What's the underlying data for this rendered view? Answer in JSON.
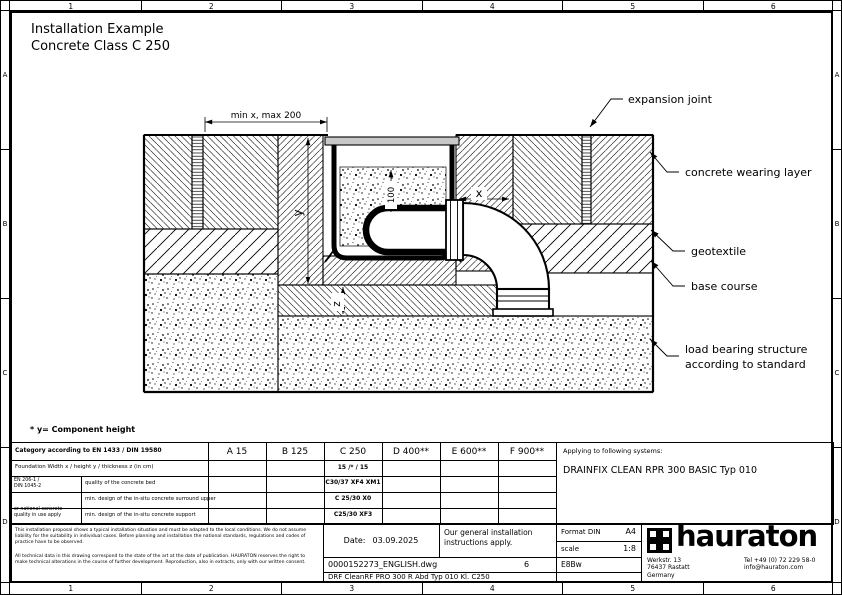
{
  "sheet": {
    "title1": "Installation Example",
    "title2": "Concrete Class C 250",
    "footnote": "* y= Component height"
  },
  "border": {
    "cols": [
      "1",
      "2",
      "3",
      "4",
      "5",
      "6"
    ],
    "rows": [
      "A",
      "B",
      "C",
      "D"
    ]
  },
  "drawing": {
    "dims": {
      "top": "min x, max 200",
      "y": "y",
      "depth": "100",
      "x": "x",
      "z": "z"
    },
    "callouts": {
      "expansion_joint": "expansion joint",
      "wearing_layer": "concrete wearing layer",
      "geotextile": "geotextile",
      "base_course": "base course",
      "load_bearing_1": "load bearing structure",
      "load_bearing_2": "according to standard"
    }
  },
  "table": {
    "category_label": "Category according to EN 1433 / DIN 19580",
    "classes": [
      "A 15",
      "B 125",
      "C 250",
      "D 400**",
      "E 600**",
      "F 900**"
    ],
    "foundation_label": "Foundation  Width x / height y / thickness z (in cm)",
    "foundation_value": "15 /* / 15",
    "norm_top": [
      "EN 206-1 /",
      "DIN 1045-2"
    ],
    "norm_bottom": [
      "or national concrete",
      "quality in use apply"
    ],
    "rows": [
      {
        "label": "quality of the concrete bed",
        "value": "C30/37 XF4 XM1"
      },
      {
        "label": "min. design of the in-situ concrete surround upper",
        "value": "C 25/30 X0"
      },
      {
        "label": "min. design of the in-situ concrete support",
        "value": "C25/30 XF3"
      }
    ],
    "applying_label": "Applying to following systems:",
    "applying_value": "DRAINFIX CLEAN RPR 300 BASIC Typ 010"
  },
  "footer": {
    "disclaimer1": "This installation proposal shows a typical installation situation and must be adapted to the local conditions. We do not assume liability for the suitability in individual cases. Before planning and installation the national standards, regulations and codes of practice have to be observed.",
    "disclaimer2": "All technical data in this drawing correspond to the state of the art at the date of publication. HAURATON reserves the right to make technical alterations in the course of further development. Reproduction, also in extracts, only with our written consent.",
    "date_label": "Date:",
    "date_value": "03.09.2025",
    "instructions": "Our general installation instructions apply.",
    "format_label": "Format DIN",
    "format_value": "A4",
    "scale_label": "scale",
    "scale_value": "1:8",
    "file_name": "0000152273_ENGLISH.dwg",
    "sheet_no": "6",
    "code": "E8Bw",
    "description": "DRF CleanRF PRO 300 R Abd Typ 010 Kl. C250",
    "brand": "hauraton",
    "address": [
      "Werkstr. 13",
      "76437 Rastatt",
      "Germany"
    ],
    "contact": [
      "Tel +49 (0) 72 229 58-0",
      "info@hauraton.com"
    ]
  },
  "colors": {
    "grating": "#c8c8c8",
    "line": "#000000"
  }
}
